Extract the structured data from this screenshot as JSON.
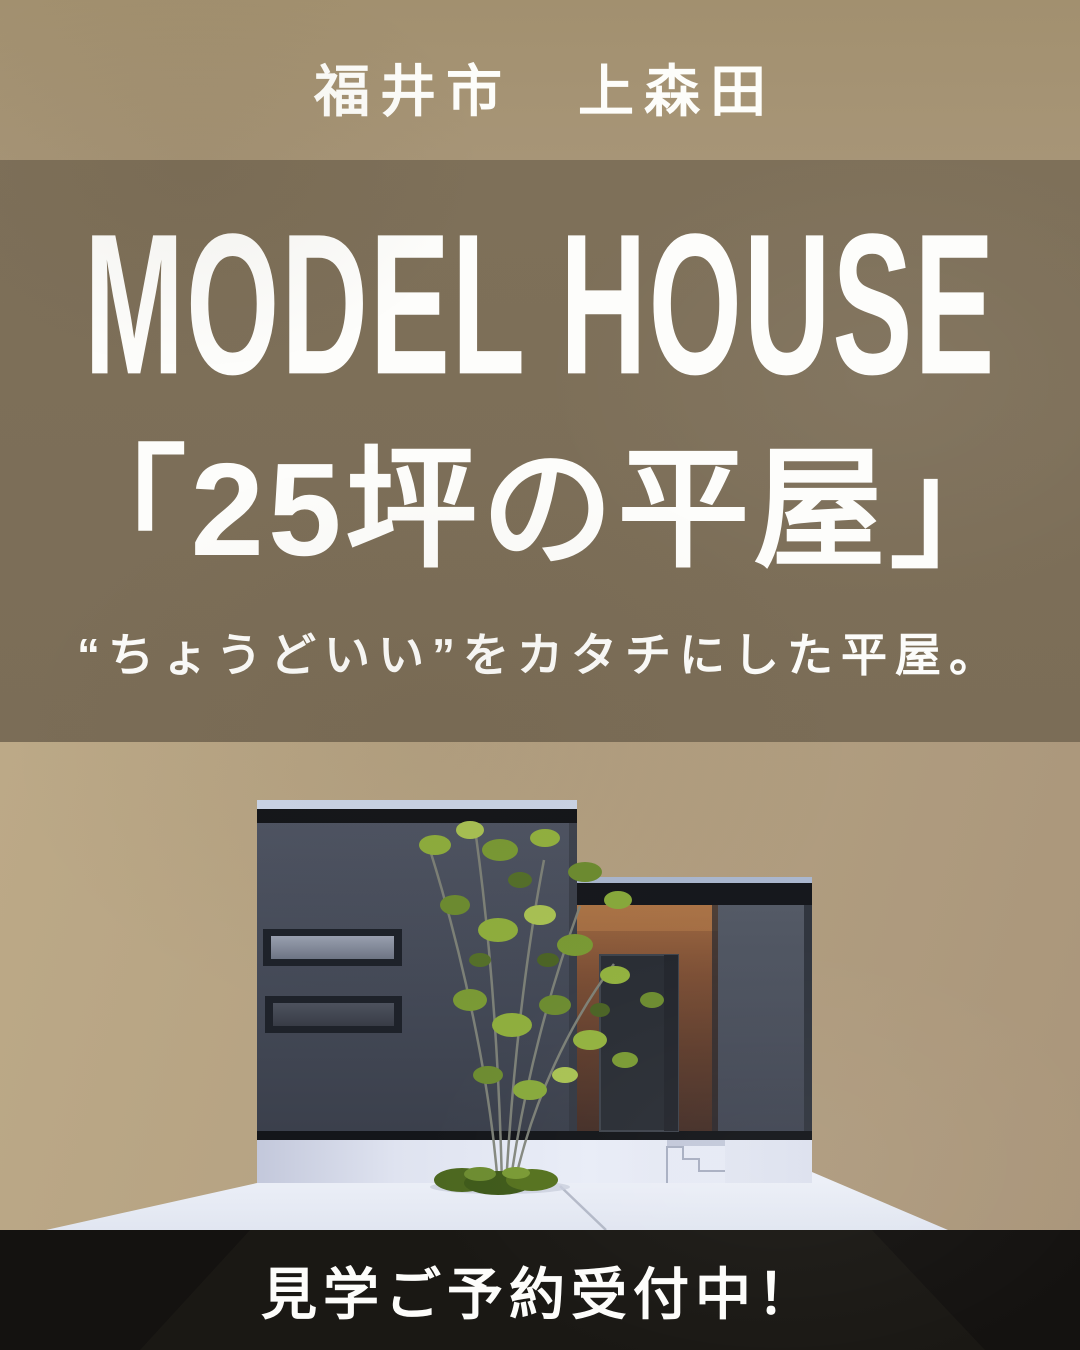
{
  "poster": {
    "location_label": "福井市　上森田",
    "title_en": "MODEL HOUSE",
    "title_jp": "「25坪の平屋」",
    "tagline": "“ちょうどいい”をカタチにした平屋。",
    "cta": "見学ご予約受付中！"
  },
  "colors": {
    "top_background": "#a69474",
    "band_background": "#7d6f58",
    "scene_background": "#b3a083",
    "footer_background": "#141210",
    "text": "#fdfdfb",
    "house_wall": "#474d59",
    "roof_fascia": "#15171b",
    "entry_wood": "#7a4e36",
    "door": "#2a2e35",
    "ground_concrete": "#edf1f8",
    "foliage_green": "#8fae3e"
  }
}
